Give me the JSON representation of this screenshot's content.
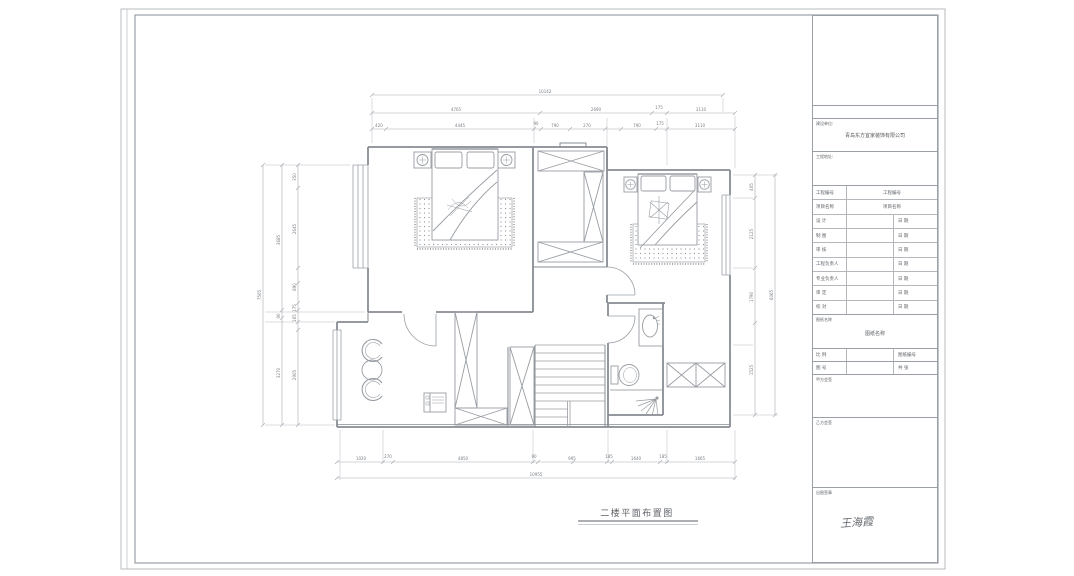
{
  "plan": {
    "caption": "二楼平面布置图",
    "dims": {
      "top_total": "10142",
      "top_row2": [
        "4765",
        "2690",
        "175",
        "3110"
      ],
      "top_row3": [
        "420",
        "4445",
        "90",
        "790",
        "270",
        "790",
        "175",
        "3110"
      ],
      "bottom_row": [
        "1020",
        "270",
        "4850",
        "90",
        "995",
        "185",
        "1640",
        "185",
        "1665"
      ],
      "bottom_total": "10955",
      "left_total": "7505",
      "left_row2": [
        "3685",
        "90",
        "3270"
      ],
      "left_row3": [
        "350",
        "2645",
        "890",
        "175",
        "165",
        "2905"
      ],
      "right_row": [
        "405",
        "2125",
        "1790",
        "1525"
      ],
      "right_total": "6065"
    }
  },
  "title_block": {
    "owner_label": "建设单位:",
    "owner_value": "青岛东方宜家装饰有限公司",
    "address_label": "工程地址:",
    "rows": [
      {
        "label": "工程编号",
        "mid": "工程编号",
        "right": ""
      },
      {
        "label": "项目名称",
        "mid": "项目名称",
        "right": ""
      },
      {
        "label": "设 计",
        "mid": "",
        "right": "日 期"
      },
      {
        "label": "制 图",
        "mid": "",
        "right": "日 期"
      },
      {
        "label": "审 核",
        "mid": "",
        "right": "日 期"
      },
      {
        "label": "工程负责人",
        "mid": "",
        "right": "日 期"
      },
      {
        "label": "专业负责人",
        "mid": "",
        "right": "日 期"
      },
      {
        "label": "审 定",
        "mid": "",
        "right": "日 期"
      },
      {
        "label": "校 对",
        "mid": "",
        "right": "日 期"
      }
    ],
    "drawing_name_label": "图纸名称",
    "drawing_name_value": "图纸名称",
    "scale_label": "比 例",
    "sheet_no_label": "图纸编号",
    "fig_label": "图 号",
    "total_label": "共 张",
    "client_sign_label": "甲方会签",
    "contractor_sign_label": "乙方会签",
    "issue_sign_label": "出图签章",
    "signature": "王海霞"
  }
}
